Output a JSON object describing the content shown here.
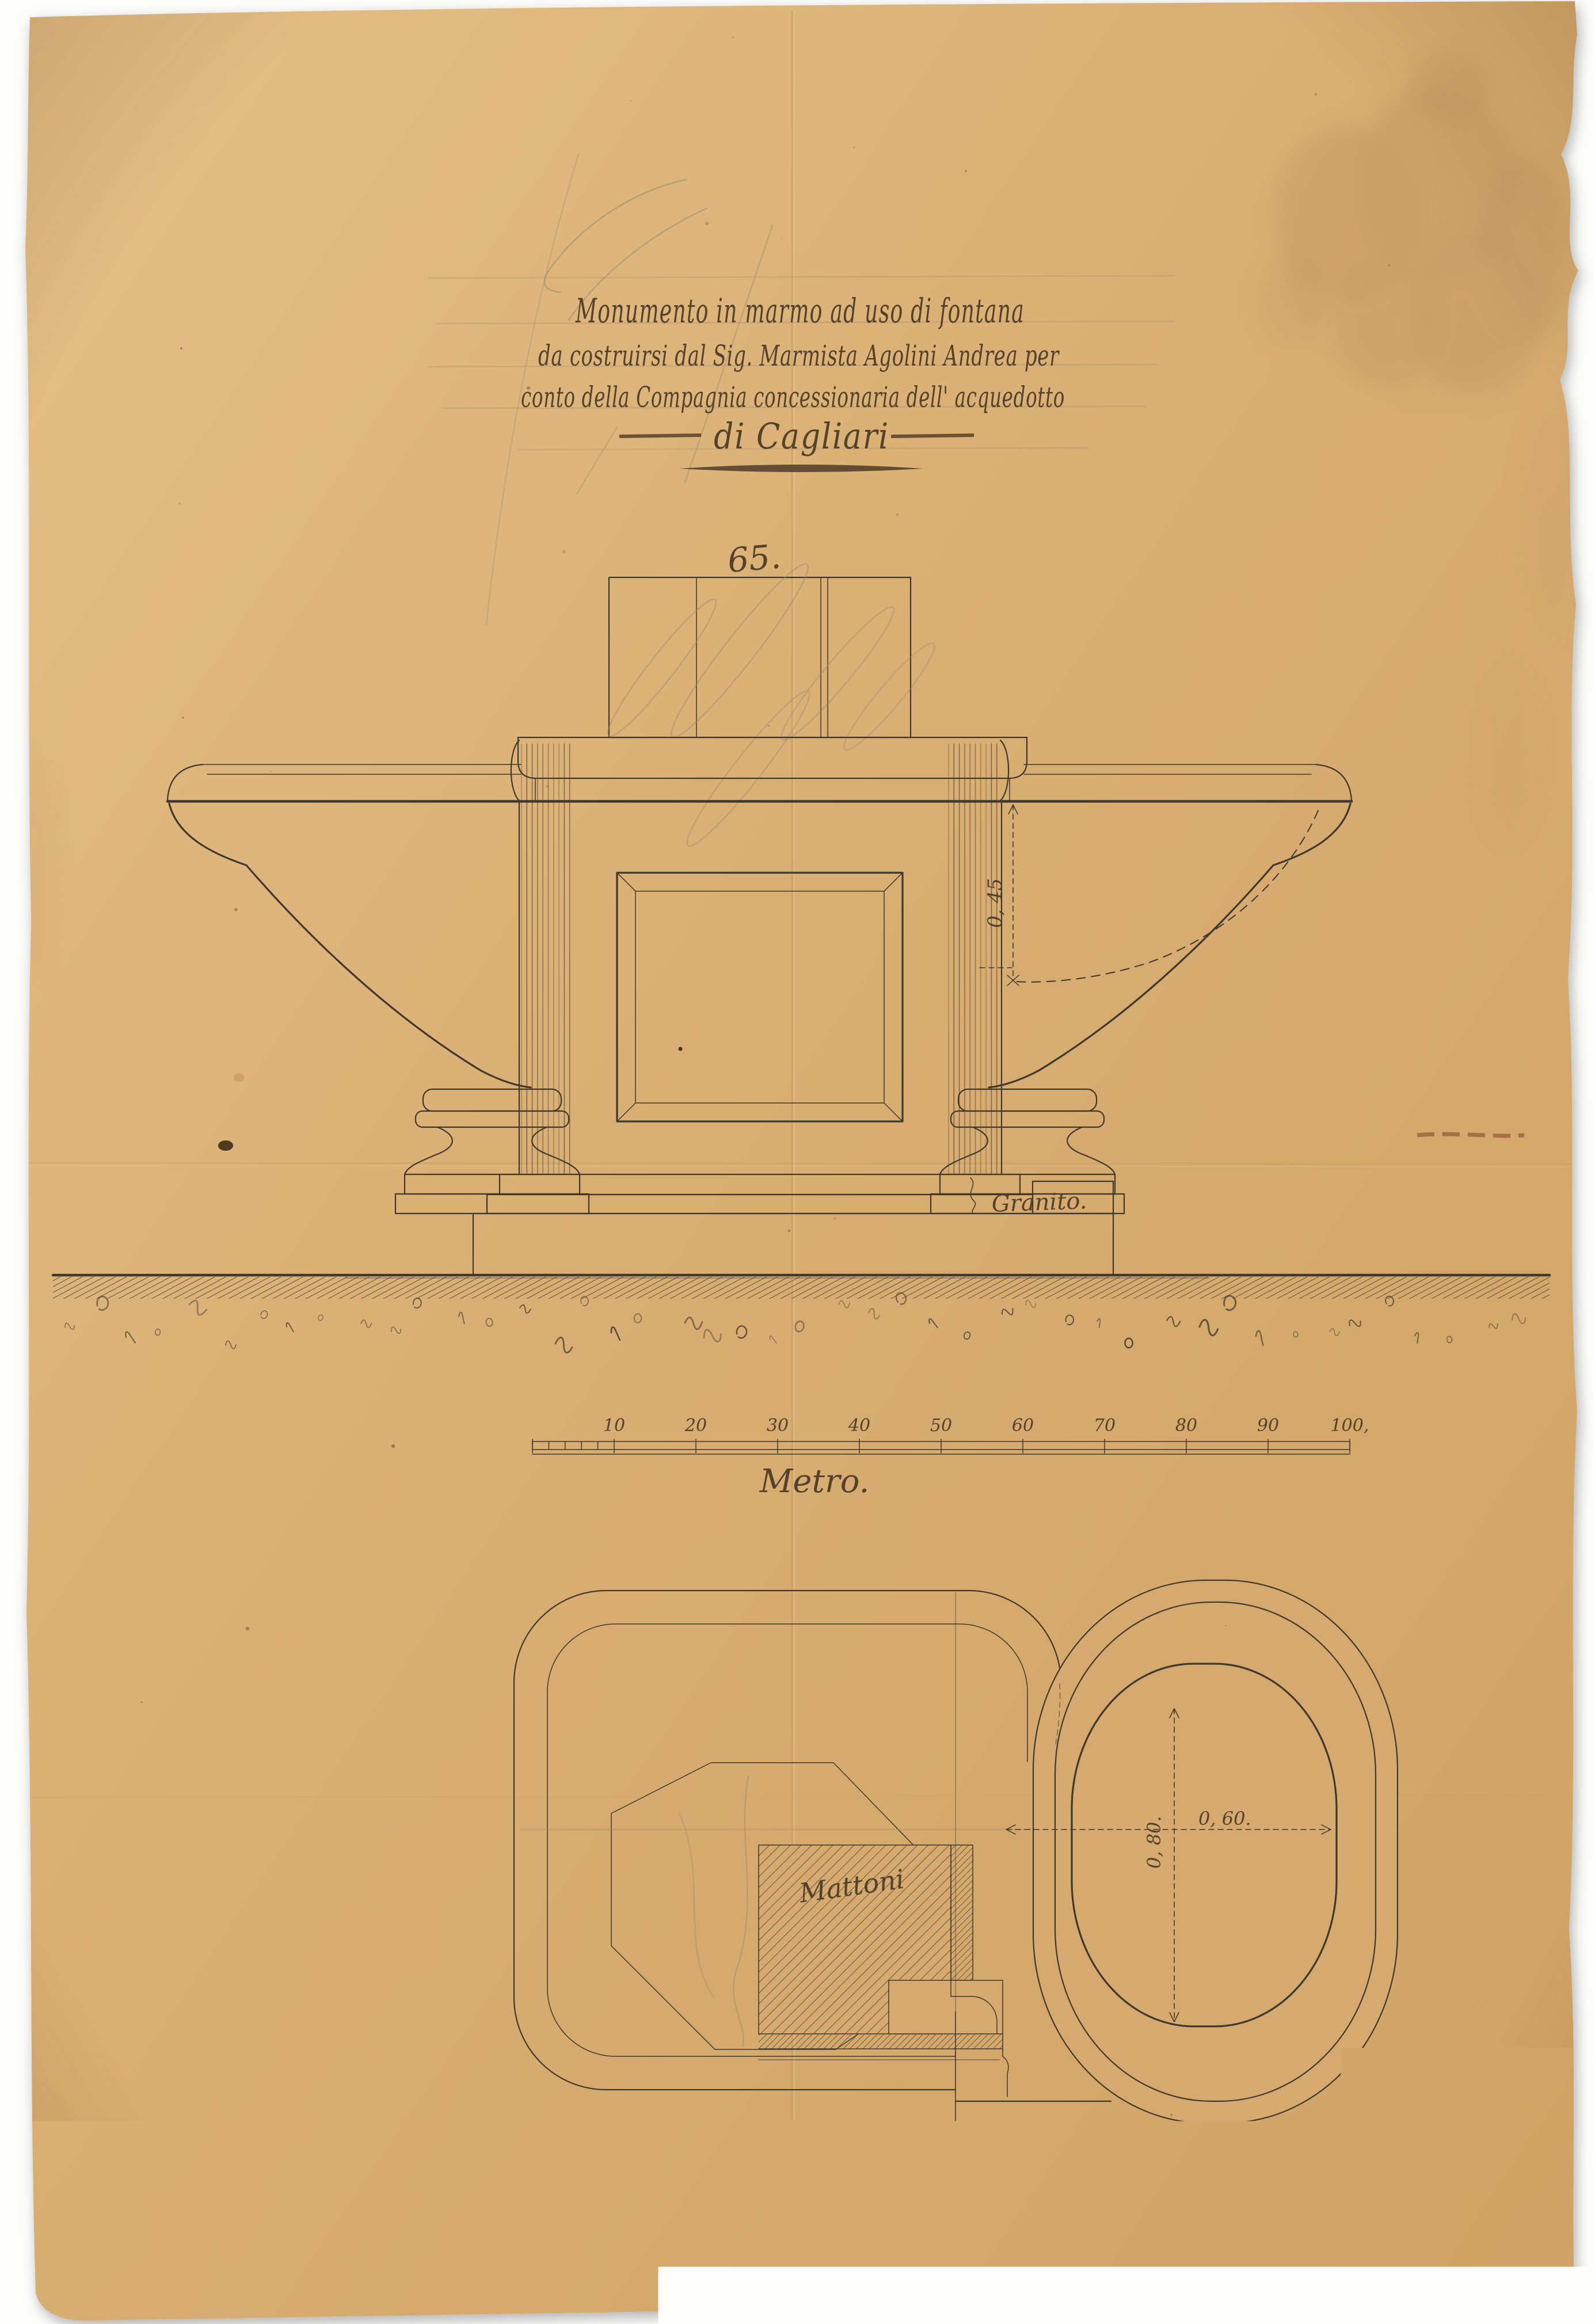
{
  "document": {
    "kind": "Scanned hand-drawn marble fountain design sheet",
    "title": {
      "line1": "Monumento in marmo ad uso di fontana",
      "line2": "da costruirsi dal Sig. Marmista Agolini Andrea per",
      "line3": "conto della Compagnia concessionaria dell' acquedotto",
      "line4": "di Cagliari"
    },
    "elevation": {
      "top_width_label": "65.",
      "basin_depth_label": "0, 45",
      "material_base_label": "Granito."
    },
    "scale_bar": {
      "caption": "Metro.",
      "ticks": [
        "10",
        "20",
        "30",
        "40",
        "50",
        "60",
        "70",
        "80",
        "90",
        "100,"
      ]
    },
    "plan": {
      "bricks_label": "Mattoni",
      "width_label": "0, 60.",
      "height_label": "0, 80."
    },
    "colors": {
      "paper": "#d9ae72",
      "ink": "#3f382e",
      "handwriting": "#54422c",
      "pencil": "#9b8a6e",
      "stain": "#bf9562",
      "scan_background": "#fdfdfc"
    }
  }
}
